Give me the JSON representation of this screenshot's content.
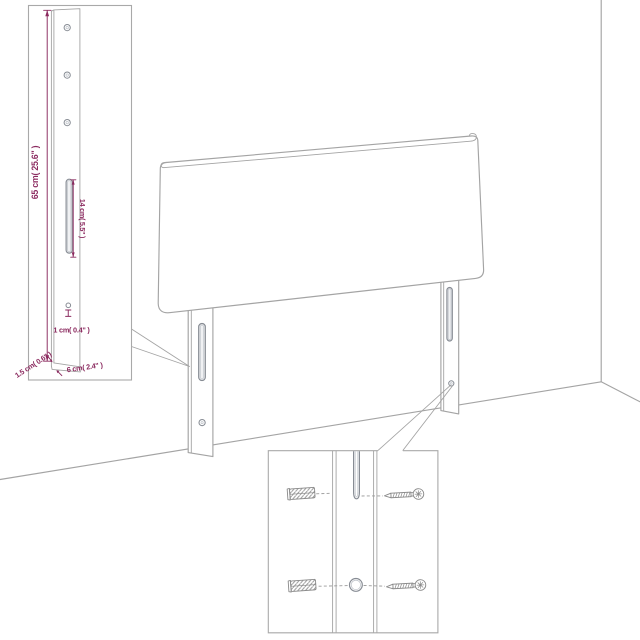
{
  "diagram": {
    "labels": {
      "leg_height": "65 cm( 25.6\" )",
      "slot_length": "14 cm( 5.5\" )",
      "hole_offset": "1 cm( 0.4\" )",
      "leg_thickness": "1.5 cm( 0.6\" )",
      "leg_width": "6 cm( 2.4\" )"
    },
    "icons": [
      "headboard-panel-drawing",
      "leg-post-drawing",
      "keyhole-slot-icon",
      "mounting-hole-icon",
      "wall-plug-icon",
      "screw-icon",
      "wall-corner-line",
      "callout-line"
    ],
    "colors": {
      "dimension": "#8b2a5f",
      "line": "#a4a4a4",
      "detail": "#878c94"
    }
  }
}
